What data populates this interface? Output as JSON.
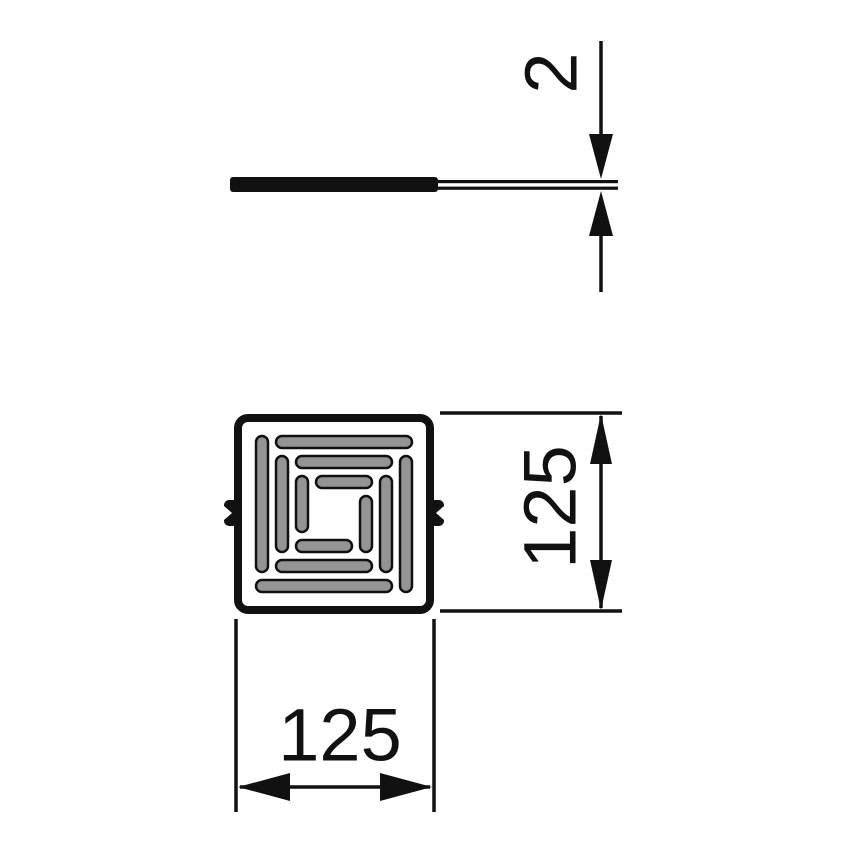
{
  "drawing": {
    "type": "technical-dimension-drawing",
    "views": {
      "side_view": "profile section of cover",
      "plan_view": "square grate with pinwheel slot pattern"
    },
    "dimensions": {
      "thickness": "2",
      "height": "125",
      "width": "125"
    }
  },
  "colors": {
    "line": "#111111",
    "slot_fill": "#949494",
    "background": "#ffffff"
  }
}
